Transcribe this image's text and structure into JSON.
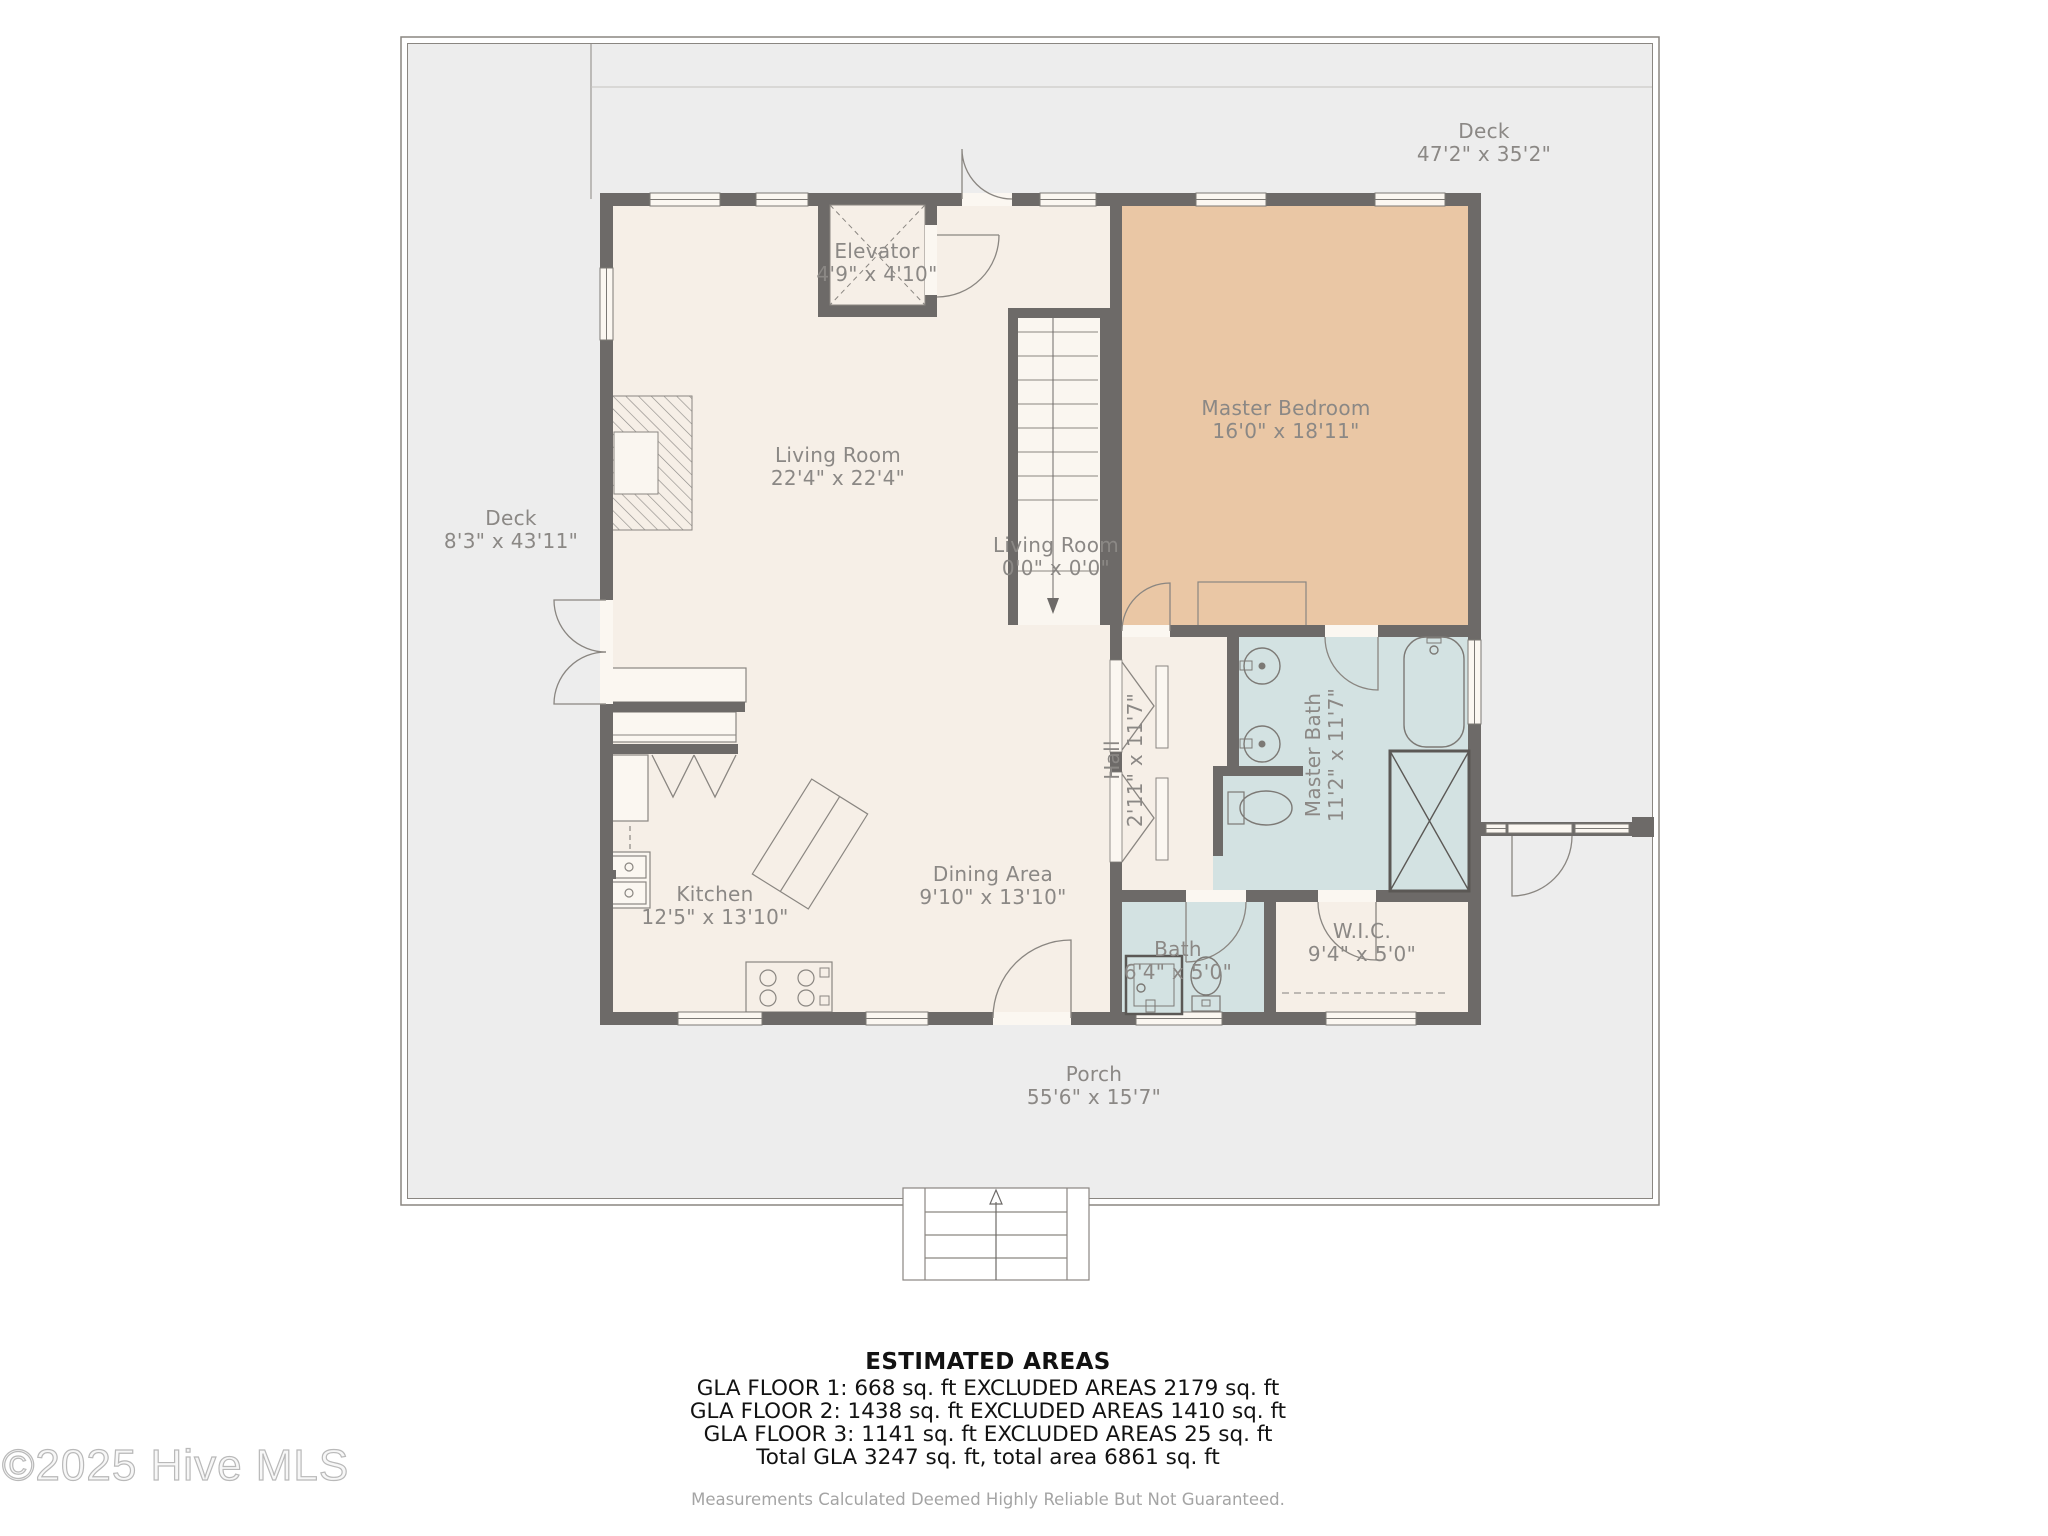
{
  "watermark": "©2025 Hive MLS",
  "rooms": {
    "deck_top": {
      "name": "Deck",
      "dims": "47'2\" x 35'2\""
    },
    "deck_left": {
      "name": "Deck",
      "dims": "8'3\" x 43'11\""
    },
    "elevator": {
      "name": "Elevator",
      "dims": "4'9\" x 4'10\""
    },
    "living": {
      "name": "Living Room",
      "dims": "22'4\" x 22'4\""
    },
    "stairwell": {
      "name": "Living Room",
      "dims": "0'0\" x 0'0\""
    },
    "master_bedroom": {
      "name": "Master Bedroom",
      "dims": "16'0\" x 18'11\""
    },
    "hall": {
      "name": "Hall",
      "dims": "2'11\" x 11'7\""
    },
    "master_bath": {
      "name": "Master Bath",
      "dims": "11'2\" x 11'7\""
    },
    "kitchen": {
      "name": "Kitchen",
      "dims": "12'5\" x 13'10\""
    },
    "dining": {
      "name": "Dining Area",
      "dims": "9'10\" x 13'10\""
    },
    "bath": {
      "name": "Bath",
      "dims": "6'4\" x 5'0\""
    },
    "wic": {
      "name": "W.I.C.",
      "dims": "9'4\" x 5'0\""
    },
    "porch": {
      "name": "Porch",
      "dims": "55'6\" x 15'7\""
    }
  },
  "footer": {
    "title": "ESTIMATED AREAS",
    "lines": [
      "GLA FLOOR 1: 668 sq. ft EXCLUDED AREAS 2179 sq. ft",
      "GLA FLOOR 2: 1438 sq. ft EXCLUDED AREAS 1410 sq. ft",
      "GLA FLOOR 3: 1141 sq. ft EXCLUDED AREAS 25 sq. ft",
      "Total GLA 3247 sq. ft, total area 6861 sq. ft"
    ],
    "disclaimer": "Measurements Calculated Deemed Highly Reliable But Not Guaranteed."
  },
  "colors": {
    "deck": "#ededed",
    "interior": "#f6efe7",
    "bedroom": "#eac7a5",
    "bathroom": "#d3e2e2",
    "wall": "#6d6a68"
  }
}
